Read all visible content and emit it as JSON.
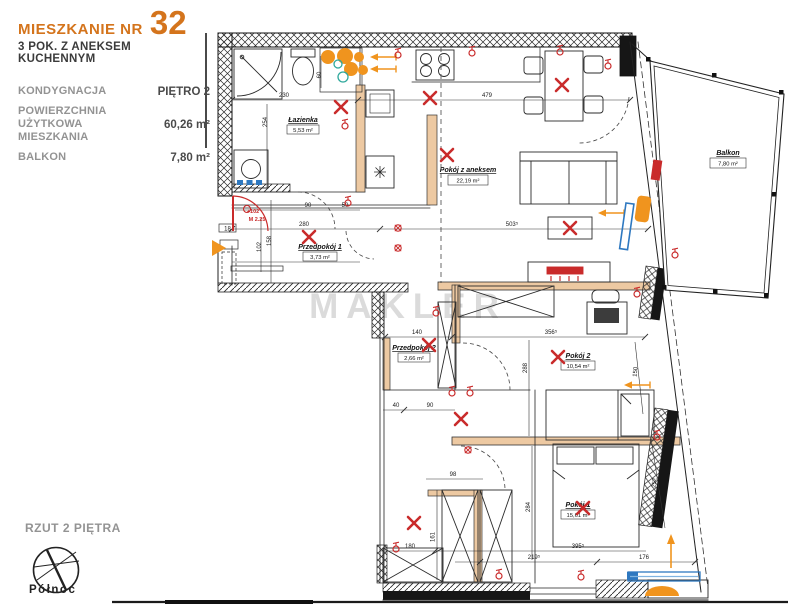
{
  "header": {
    "title_prefix": "MIESZKANIE NR",
    "title_number": "32",
    "subtitle": "3 POK. Z ANEKSEM KUCHENNYM",
    "specs": [
      {
        "label": "KONDYGNACJA",
        "value": "PIĘTRO 2"
      },
      {
        "label": "POWIERZCHNIA UŻYTKOWA MIESZKANIA",
        "value": "60,26 m²"
      },
      {
        "label": "BALKON",
        "value": "7,80 m²"
      }
    ]
  },
  "footer": {
    "plan_label": "RZUT 2 PIĘTRA",
    "north_label": "Północ"
  },
  "watermark": "MAKLER",
  "rooms": [
    {
      "name": "Łazienka",
      "area": "5,53 m²"
    },
    {
      "name": "Pokój z aneksem",
      "area": "22,19 m²"
    },
    {
      "name": "Przedpokój 1",
      "area": "3,73 m²"
    },
    {
      "name": "Przedpokój 2",
      "area": "2,66 m²"
    },
    {
      "name": "Pokój 2",
      "area": "10,54 m²"
    },
    {
      "name": "Pokój 1",
      "area": "15,61 m²"
    },
    {
      "name": "Balkon",
      "area": "7,80 m²"
    }
  ],
  "dims": [
    "230",
    "479",
    "254",
    "60",
    "90",
    "50",
    "280",
    "330",
    "18",
    "102",
    "158",
    "503⁵",
    "140",
    "356⁵",
    "288",
    "150",
    "40",
    "90",
    "98",
    "161",
    "180",
    "284",
    "395⁵",
    "219⁵",
    "176",
    "252"
  ],
  "red_notes": [
    "+102",
    "M 2.25"
  ],
  "colors": {
    "brand_orange": "#d4741c",
    "symbol_orange": "#f0941e",
    "symbol_red": "#c92b2b",
    "symbol_teal": "#2fa89c",
    "symbol_blue": "#2e78c0",
    "wall_tan": "#edc9a2",
    "watermark_gray": "#c6c6c6"
  }
}
